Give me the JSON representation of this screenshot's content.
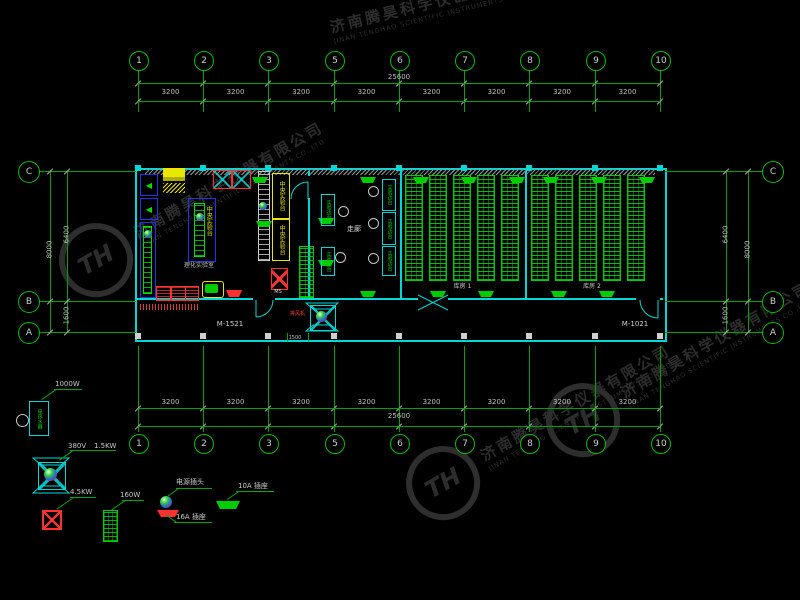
{
  "watermark": {
    "logo_text": "TH",
    "company_cn": "济南腾昊科学仪器有限公司",
    "company_en": "JINAN TENGHAO SCIENTIFIC INSTRUMENTS CO.,LTD"
  },
  "colors": {
    "background": "#000000",
    "grid_green": "#00a400",
    "wall_cyan": "#00d8d8",
    "bench_green": "#00dd00",
    "accent_blue": "#2233ee",
    "accent_red": "#ff3030",
    "accent_yellow": "#e8e800",
    "dim_text": "#bfbfbf",
    "watermark_gray": "#2d2d2d"
  },
  "axes": {
    "h_bubbles": [
      "1",
      "2",
      "3",
      "5",
      "6",
      "7",
      "8",
      "9",
      "10"
    ],
    "h_segments": [
      "3200",
      "3200",
      "3200",
      "3200",
      "3200",
      "3200",
      "3200",
      "3200"
    ],
    "h_total": "25600",
    "v_bubbles": [
      "C",
      "B",
      "A"
    ],
    "left_dims": {
      "total": "8000",
      "upper": "6400",
      "lower": "1600"
    },
    "right_dims": {
      "total": "8000",
      "upper": "6400",
      "lower": "1600"
    }
  },
  "plan": {
    "doors": {
      "left": "M-1521",
      "right": "M-1021"
    },
    "entry_dim": "1500",
    "fan_label": "排风机",
    "ms_label": "MS",
    "rooms": {
      "lab": {
        "name": "理化实验室",
        "bench_label": "中央实验台"
      },
      "corridor": {
        "name": "走廊",
        "wall_labels": [
          "实验边台",
          "实验边台",
          "实验边台",
          "实验边台",
          "实验边台"
        ]
      },
      "storage": [
        {
          "name": "库房 1",
          "rack_columns": 5
        },
        {
          "name": "库房 2",
          "rack_columns": 5
        }
      ]
    }
  },
  "legend": {
    "water_heater": {
      "symbol_text": "电热水器",
      "power": "1000W"
    },
    "exhaust_fan": {
      "voltage": "380V",
      "power": "1.5KW"
    },
    "furnace": {
      "power": "4.5KW"
    },
    "heater": {
      "power": "160W"
    },
    "plug": {
      "label": "电源插头"
    },
    "socket_16a": {
      "label": "16A 插座"
    },
    "socket_10a": {
      "label": "10A 插座"
    }
  }
}
